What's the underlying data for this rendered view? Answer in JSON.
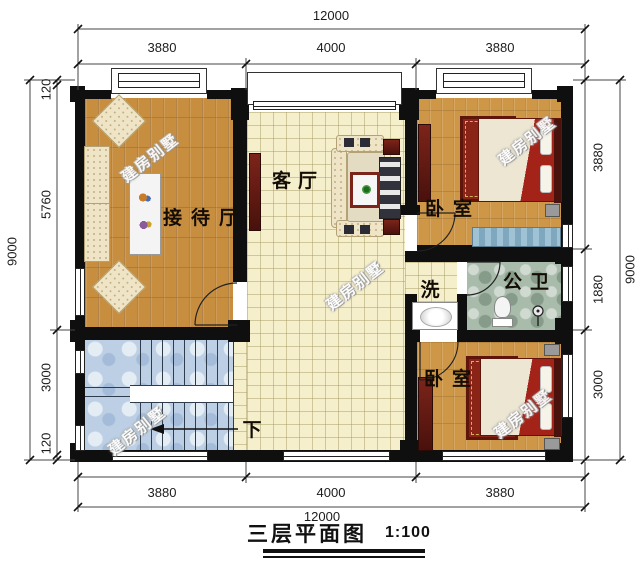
{
  "caption": {
    "text": "三层平面图",
    "scale": "1:100"
  },
  "watermark": {
    "text": "建房别墅"
  },
  "dims": {
    "top": {
      "overall": "12000",
      "segments": [
        "3880",
        "4000",
        "3880"
      ]
    },
    "bottom": {
      "overall": "12000",
      "segments": [
        "3880",
        "4000",
        "3880"
      ]
    },
    "left": {
      "overall": "9000",
      "segments": [
        "120",
        "5760",
        "3000",
        "120"
      ]
    },
    "right": {
      "overall": "9000",
      "segments": [
        "3880",
        "1880",
        "3000"
      ]
    }
  },
  "rooms": {
    "reception": {
      "label": "接待厅"
    },
    "living": {
      "label": "客厅"
    },
    "bedroom_top": {
      "label": "卧室"
    },
    "bedroom_bottom": {
      "label": "卧室"
    },
    "wash": {
      "label": "洗"
    },
    "bathroom": {
      "label": "公卫"
    },
    "stairs": {
      "direction_label": "下"
    }
  },
  "colors": {
    "wall": "#0f0f0f",
    "wood_floor": "#c88e40",
    "tile_floor": "#f6efcb",
    "stairs_floor": "#bccfe4",
    "bath_floor": "#a9bcab",
    "furniture_red": "#6e2018",
    "bed_red": "#a32318",
    "bench_blue": "#8fb8cc"
  }
}
